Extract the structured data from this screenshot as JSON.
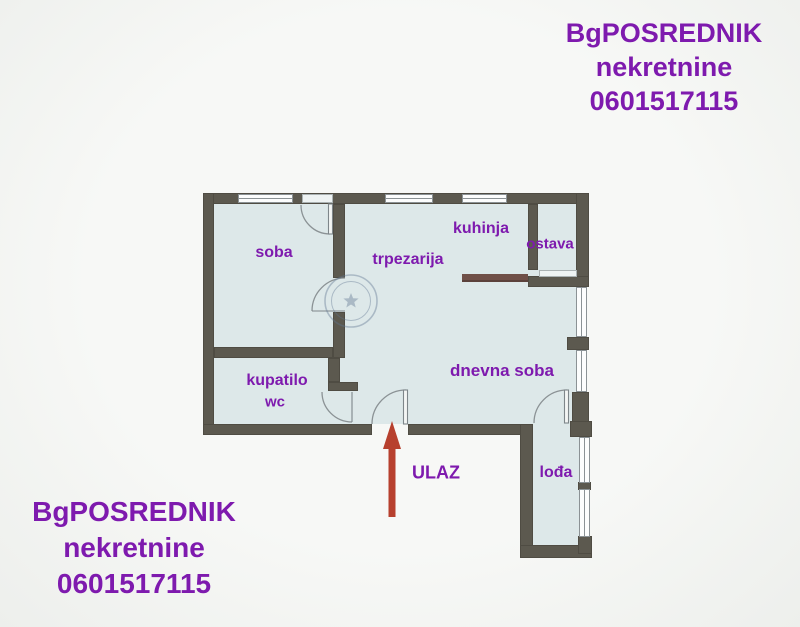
{
  "watermark_top": {
    "lines": [
      "BgPOSREDNIK",
      "nekretnine",
      "0601517115"
    ]
  },
  "watermark_bottom": {
    "lines": [
      "BgPOSREDNIK",
      "nekretnine",
      "0601517115"
    ]
  },
  "floorplan": {
    "rooms": [
      {
        "name": "soba"
      },
      {
        "name": "trpezarija"
      },
      {
        "name": "kuhinja"
      },
      {
        "name": "ostava"
      },
      {
        "name": "kupatilo",
        "subname": "wc"
      },
      {
        "name": "dnevna soba"
      },
      {
        "name": "lođa"
      }
    ],
    "entrance_label": "ULAZ",
    "stamp_icon": "star-seal",
    "colors": {
      "wall": "#5c594f",
      "floor": "#dde8e9",
      "label_purple": "#7e1aae",
      "arrow_red": "#b7402e",
      "counter_brown": "#705048"
    }
  }
}
